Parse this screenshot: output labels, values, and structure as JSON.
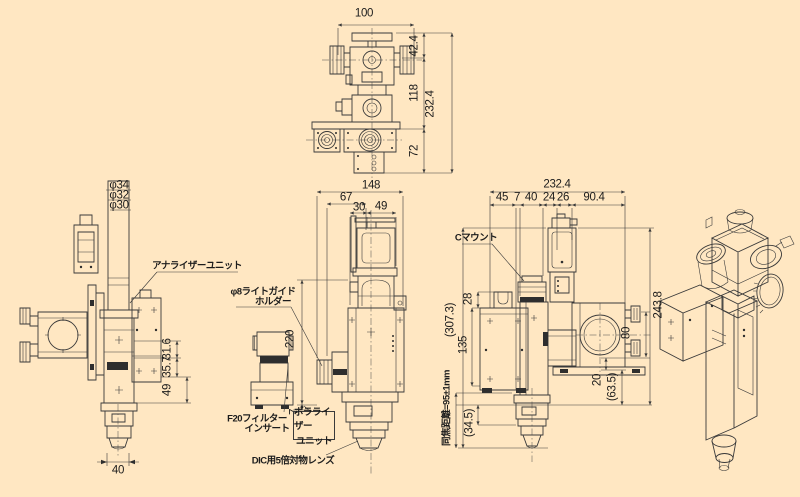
{
  "palette": {
    "background": "#FFE7C2",
    "line_color": "#3a3a3a",
    "text_color": "#1c1c1c",
    "dark_fill": "#2e2e2e"
  },
  "views": {
    "top_front": {
      "dims": {
        "overall_width": "100",
        "upper": "42.4",
        "middle": "118",
        "lower": "72",
        "overall_height": "232.4"
      }
    },
    "left_side": {
      "dims": {
        "dia_outer": "φ34",
        "dia_mid": "φ32",
        "dia_inner": "φ30",
        "seg_upper": "31.6",
        "seg_mid": "35.7",
        "seg_lower": "49",
        "bottom_width": "40"
      },
      "labels": {
        "analyzer_unit": "アナライザーユニット"
      }
    },
    "center_front": {
      "dims": {
        "overall_width": "148",
        "left_width": "67",
        "seg_a": "30",
        "seg_b": "49",
        "height": "220",
        "offset": "7"
      },
      "labels": {
        "light_guide_line1": "φ8ライトガイド",
        "light_guide_line2": "ホルダー",
        "filter_line1": "F20フィルター",
        "filter_line2": "インサート",
        "polarizer_line1": "ポラライザー",
        "polarizer_line2": "ユニット",
        "objective": "DIC用5倍対物レンズ"
      }
    },
    "right_side": {
      "dims": {
        "overall_width": "232.4",
        "seg1": "45",
        "seg2": "7",
        "seg3": "40",
        "seg4": "24",
        "seg5": "26",
        "seg6": "90.4",
        "overall_height": "(307.3)",
        "bracket_height": "28",
        "body_height": "135",
        "lower_offset": "(34.5)",
        "parfocal": "同焦距離=95±1mm",
        "right_height": "243.8",
        "port_height": "80",
        "plate_height": "20",
        "foot_height": "(63.5)"
      },
      "labels": {
        "c_mount": "Cマウント"
      }
    }
  }
}
